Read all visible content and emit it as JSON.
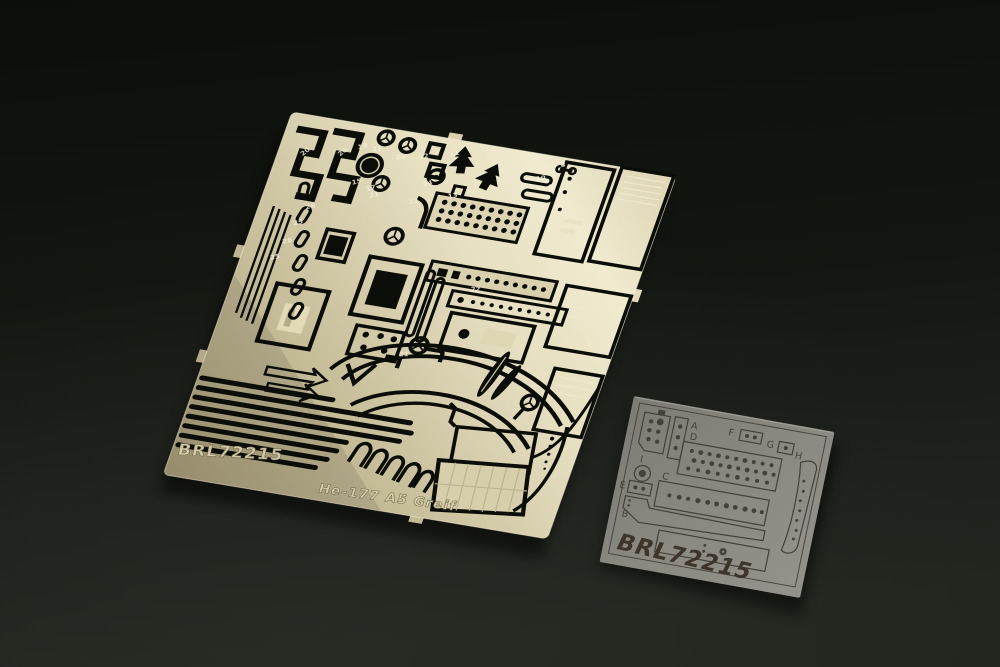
{
  "photo": {
    "background": {
      "color_top": "#0b0f0a",
      "color_bottom": "#23261f"
    },
    "large_fret": {
      "metal_color": "#cfc6a2",
      "metal_highlight": "#efe9cc",
      "metal_shadow": "#a89d79",
      "cutout_color": "#0b0d09",
      "etched_code": "BRL72215",
      "etched_title": "He-177 A5 Greif",
      "part_numbers": [
        "20",
        "20",
        "21",
        "21",
        "19",
        "15",
        "17",
        "12",
        "11",
        "22",
        "21",
        "14",
        "13",
        "8",
        "10",
        "9",
        "26",
        "25",
        "26",
        "25",
        "22",
        "21"
      ]
    },
    "film_sheet": {
      "film_color": "#8a8a82",
      "ink_color": "#45403a",
      "code": "BRL72215",
      "section_labels": [
        "A",
        "F",
        "G",
        "H",
        "D",
        "I",
        "C",
        "E",
        "B"
      ]
    }
  }
}
